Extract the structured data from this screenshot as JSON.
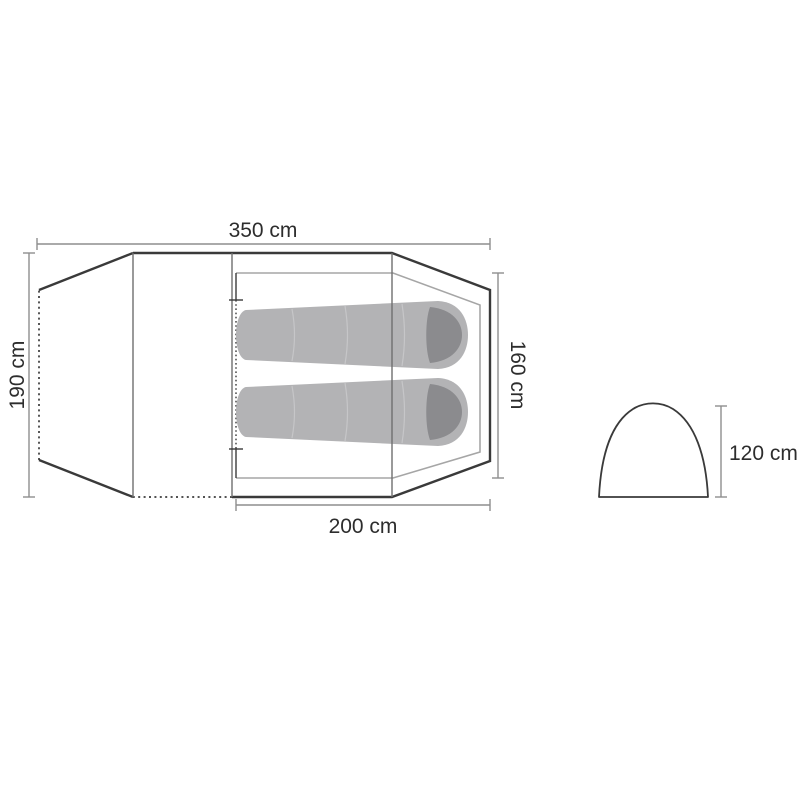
{
  "page": {
    "background": "#ffffff"
  },
  "colors": {
    "page-bg": "#ffffff",
    "outline": "#3a3a3a",
    "fold-line": "#6f6f6f",
    "inner-outline": "#a6a6a6",
    "dimension": "#8e8e8e",
    "label-text": "#2d2d2d",
    "bag-fill": "#b3b3b5",
    "bag-hood": "#8b8b8e",
    "bag-seam": "#c6c6c8"
  },
  "diagram": {
    "type": "tent-dimension-drawing",
    "views": {
      "floorplan": {
        "description": "top view of tent with vestibule, inner cabin and two sleeping bags",
        "sleeping_bag_count": 2,
        "dimensions": {
          "total_length": {
            "label": "350 cm",
            "value": 350,
            "unit": "cm"
          },
          "outer_width": {
            "label": "190 cm",
            "value": 190,
            "unit": "cm"
          },
          "inner_width": {
            "label": "160 cm",
            "value": 160,
            "unit": "cm"
          },
          "inner_length": {
            "label": "200 cm",
            "value": 200,
            "unit": "cm"
          }
        }
      },
      "side_profile": {
        "description": "dome cross-section side view",
        "dimensions": {
          "peak_height": {
            "label": "120 cm",
            "value": 120,
            "unit": "cm"
          }
        }
      }
    }
  }
}
